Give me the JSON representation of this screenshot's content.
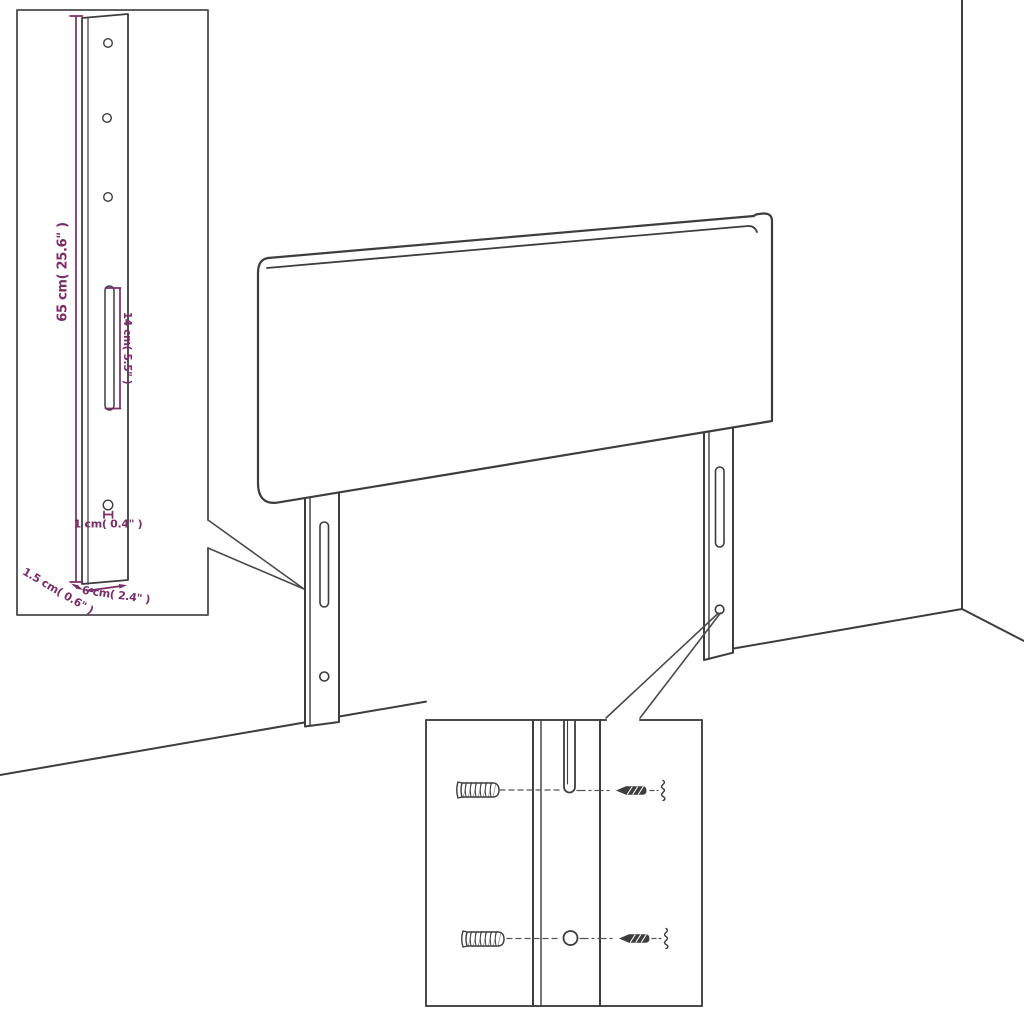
{
  "diagram": {
    "kind": "headboard-dimension-diagram",
    "colors": {
      "background": "#ffffff",
      "line": "#3d3d3d",
      "dimension": "#7b2d68"
    },
    "icons": {
      "wall_plug": "wall-plug-icon",
      "screw": "screw-icon"
    },
    "leg_detail_inset": {
      "dimensions": {
        "height": "65 cm( 25.6\" )",
        "slot_length": "14 cm( 5.5\" )",
        "hole_diameter": "1 cm( 0.4\" )",
        "thickness": "1.5 cm( 0.6\" )",
        "width": "6 cm( 2.4\" )"
      }
    }
  }
}
